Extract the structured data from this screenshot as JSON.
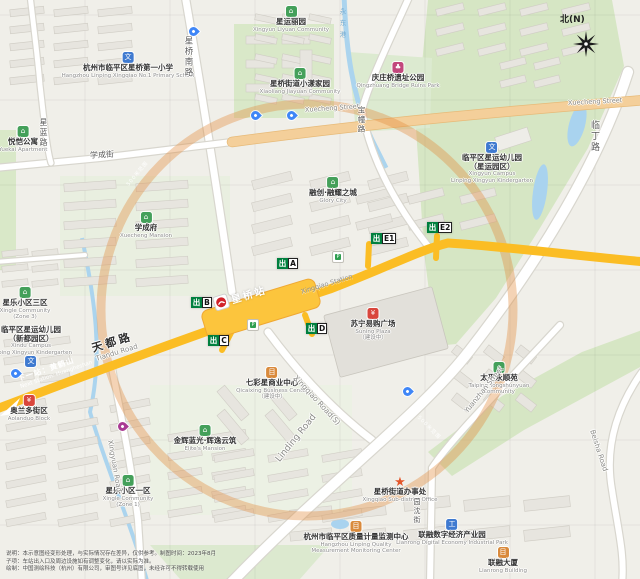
{
  "compass": {
    "label": "北(N)"
  },
  "metro": {
    "exit_prefix": "出",
    "station_zh": "星桥站",
    "station_en": "Xingqiao Station",
    "next_zh": "下一站：黄鹤山",
    "next_en": "Next Station: Huangheshan",
    "line_color": "#fbbd24",
    "exits": [
      "A",
      "B",
      "C",
      "D",
      "E1",
      "E2"
    ]
  },
  "ring": {
    "label": "500米范围",
    "color": "#e28c3c"
  },
  "river": {
    "label": "永东港"
  },
  "road_labels": [
    {
      "text": "星桥南路"
    },
    {
      "text": "星蓝路"
    },
    {
      "text": "学成街"
    },
    {
      "text": "Xuecheng Street"
    },
    {
      "text": "Xuecheng Street"
    },
    {
      "text": "宝幢路"
    },
    {
      "text": "临丁路"
    },
    {
      "text": "Linding Road"
    },
    {
      "text": "Xingqiao Road(S)"
    },
    {
      "text": "Xingyuan Road"
    },
    {
      "text": "Yuanzhan Street"
    },
    {
      "text": "园沈街"
    },
    {
      "text": "Beisha Road"
    },
    {
      "text": "天都路"
    },
    {
      "text": "Tiandu Road"
    }
  ],
  "pois": [
    {
      "zh": "杭州市临平区星桥第一小学",
      "en": "Hangzhou Linping Xingqiao No.1 Primary School",
      "icon": "school"
    },
    {
      "zh": "星运丽园",
      "en": "Xingyun Liyuan Community",
      "icon": "community"
    },
    {
      "zh": "星桥街道小漾家园",
      "en": "Xiaoliang Jiayuan Community",
      "icon": "community"
    },
    {
      "zh": "庆庄桥遗址公园",
      "en": "Qingzhuang Bridge Ruins Park",
      "icon": "park"
    },
    {
      "zh": "临平区星运幼儿园",
      "zh2": "（星运园区）",
      "en": "Xingyun Campus",
      "en2": "Linping Xingyun Kindergarten",
      "icon": "school"
    },
    {
      "zh": "悦恺公寓",
      "en": "Yuekai Apartment",
      "icon": "community"
    },
    {
      "zh": "学成府",
      "en": "Xuecheng Mansion",
      "icon": "community"
    },
    {
      "zh": "融创·融耀之城",
      "en": "Glory City",
      "icon": "community"
    },
    {
      "zh": "星乐小区三区",
      "en": "Xingle Community",
      "en2": "(Zone 3)",
      "icon": "community"
    },
    {
      "zh": "临平区星运幼儿园",
      "zh2": "（新都园区）",
      "en": "Xindu Campus",
      "en2": "Linping Xingyun Kindergarten",
      "icon": "school"
    },
    {
      "zh": "苏宁易购广场",
      "en": "Suning Plaza",
      "sub": "（建设中）",
      "icon": "mall"
    },
    {
      "zh": "七彩星商业中心",
      "en": "Qicaixing Business Center",
      "sub": "（建设中）",
      "icon": "building"
    },
    {
      "zh": "金辉蓝光·辉逸云筑",
      "en": "Elite's Mansion",
      "icon": "community"
    },
    {
      "zh": "奥兰多街区",
      "en": "Aolanduo Block",
      "icon": "mall"
    },
    {
      "zh": "星乐小区一区",
      "en": "Xingle Community",
      "en2": "(Zone 1)",
      "icon": "community"
    },
    {
      "zh": "太平永顺苑",
      "en": "Taiping Yongshunyuan",
      "en2": "Community",
      "icon": "community"
    },
    {
      "zh": "星桥街道办事处",
      "en": "Xingqiao Sub-district Office",
      "icon": "gov"
    },
    {
      "zh": "杭州市临平区质量计量监测中心",
      "en": "Hangzhou Linping Quality",
      "en2": "Measurement Monitoring Center",
      "icon": "building"
    },
    {
      "zh": "联融数字经济产业园",
      "en": "Lianrong Digital Economy Industrial Park",
      "icon": "tech"
    },
    {
      "zh": "联融大厦",
      "en": "Lianrong Building",
      "icon": "building"
    }
  ],
  "facilities": {
    "bike_label": "P"
  },
  "footer": {
    "line1": "说明：本示意图经变形处理，与实际情况存在差异，仅供参考。制图时间：2023年8月",
    "line2": "子项：车站出入口及周边设施如有调整变化，请以实际为准。",
    "line3": "绘制：中国测绘科技（杭州）有限公司，审图号详见底图，未经许可不得转载使用"
  }
}
